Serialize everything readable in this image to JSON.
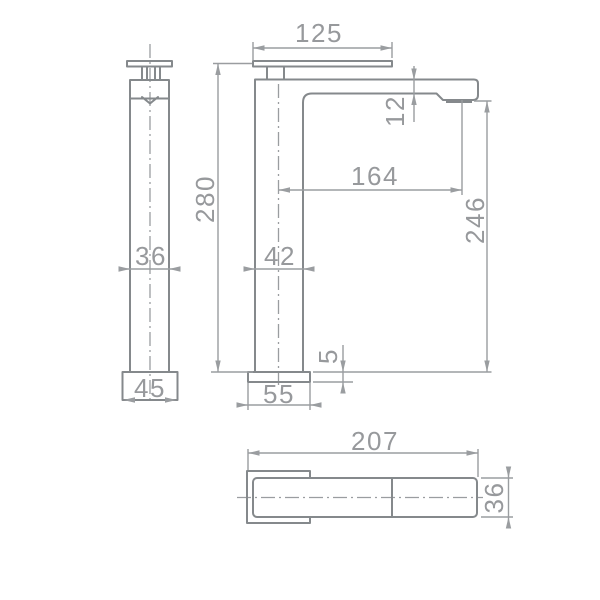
{
  "drawing": {
    "type": "technical-dimension-drawing",
    "subject": "tall single-lever basin mixer tap, three orthographic views",
    "colors": {
      "background": "#ffffff",
      "object_line": "#85898c",
      "dimension_line": "#9a9da0",
      "text": "#97999c"
    },
    "dims": {
      "side": {
        "body_width": "36",
        "base_width": "45"
      },
      "front": {
        "handle_length": "125",
        "spout_wall": "12",
        "spout_reach": "164",
        "outlet_height": "246",
        "total_height": "280",
        "body_width": "42",
        "base_plate_height": "5",
        "base_width": "55"
      },
      "top": {
        "overall_depth": "207",
        "spout_width": "36"
      }
    }
  }
}
